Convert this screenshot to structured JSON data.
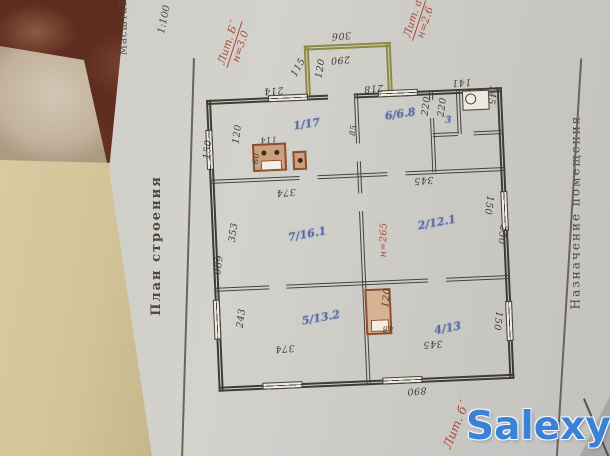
{
  "document": {
    "scale_prefix": "Масштаб",
    "scale_value": "1:100",
    "left_title": "План строения",
    "right_title": "Назначение помещения"
  },
  "plan": {
    "rooms": [
      "1/17",
      "6/6.8",
      "3",
      "7/16.1",
      "2/12.1",
      "5/13.2",
      "4/13"
    ],
    "dims": [
      "306",
      "290",
      "115",
      "120",
      "214",
      "218",
      "141",
      "145",
      "220",
      "220",
      "85",
      "150",
      "120",
      "114",
      "60",
      "374",
      "345",
      "353",
      "690",
      "243",
      "150",
      "250",
      "120",
      "48",
      "150",
      "374",
      "345",
      "890"
    ],
    "red": {
      "lit_b_label": "Лит. Б´",
      "lit_b_h": "н=3.0",
      "lit_a_label": "Лит. а",
      "lit_a_h": "н=2.6",
      "mid_height": "н=265",
      "bottom_note": "Лит. б´"
    }
  },
  "watermark": "Salexy",
  "colors": {
    "ink": "#3f3d31",
    "room_blue": "#5a6da8",
    "note_red": "#b0473a",
    "porch_olive": "#8f8a42",
    "stove_brown": "#8c4f30",
    "watermark_blue": "#3b82d6"
  }
}
